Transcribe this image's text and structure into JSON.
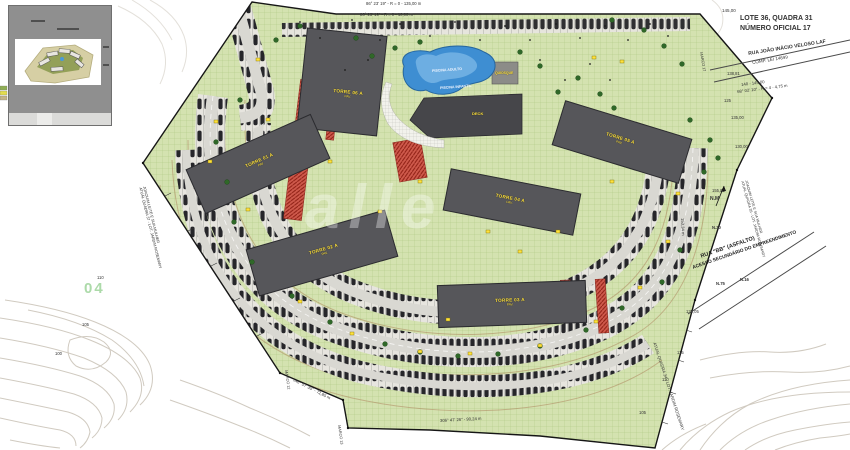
{
  "title_block": {
    "line1": "LOTE 36, QUADRA 31",
    "line2": "NÚMERO OFICIAL 17"
  },
  "streets": {
    "rua_joao_line1": "RUA JOÃO INÁCIO VELOSO LAF",
    "rua_joao_line2": "COMP. LEI 14699",
    "rua_bb_line1": "RUA \"BB\" (ASFALTO)",
    "rua_bb_line2": "ACESSO SECUNDÁRIO DO EMPREENDIMENTO"
  },
  "bearings": {
    "top_1": "86° 23' 19\" - R = 0 - 135,00 m",
    "top_2": "86° 23' 19\" - R = 0 - 10,00 m",
    "right_top": "68° 02' 10\" - R = 4 - 4,75 m",
    "right_len": "153,34 m",
    "bottom": "306° 47' 26\" - 90,24 m",
    "bottom_left": "146° 57' 35\" - 72,85 m"
  },
  "neighbors": {
    "left_line1": "JOAQUIM LEITE E SUA MULHER",
    "left_line2": "ATUAL QUADRA 37 - LOT. JARDIM ROSEMARY",
    "right_upper_line1": "JOAQUIM LEITE E SUA MULHER",
    "right_upper_line2": "ATUAL QUADRA 35 - LOT. JARDIM ROSEMARY",
    "bottom_right": "ATUAL QUADRA 34 - LOT. JARDIM ROSEMARY"
  },
  "towers": [
    {
      "label": "TORRE 01 A",
      "sub": "PAV."
    },
    {
      "label": "TORRE 02 A",
      "sub": "PAV."
    },
    {
      "label": "TORRE 03 A",
      "sub": "PAV."
    },
    {
      "label": "TORRE 04 A",
      "sub": "PAV."
    },
    {
      "label": "TORRE 05 A",
      "sub": "PAV."
    },
    {
      "label": "TORRE 06 A",
      "sub": "PAV."
    }
  ],
  "amenities": {
    "pool_adult": "PISCINA ADULTO",
    "pool_kids": "PISCINA INFANTIL",
    "deck": "DECK",
    "kiosk": "QUIOSQUE"
  },
  "survey_marks": {
    "marco_12": "MARCO 12",
    "marco_13": "MARCO 13",
    "marco_17": "MARCO 17",
    "n30": "N.30",
    "n75": "N.75",
    "n16": "N.16",
    "nm": "N.M"
  },
  "elevations": {
    "e145": "145,00",
    "e138": "138,81",
    "e140_145": "140 - 145,00",
    "e125": "125",
    "e135": "135,00",
    "e130": "130,00",
    "e155": "155,00",
    "e13505": "135,05",
    "e115": "115",
    "e110_r": "110",
    "e105_r": "105",
    "e110_l": "110",
    "e105_l": "105",
    "e100": "100"
  },
  "page_number": "04",
  "watermark": "alle",
  "colors": {
    "parcel_green": "#d4e2b0",
    "tower_gray": "#56565a",
    "label_yellow": "#ffe23c",
    "pool_blue": "#3e8ed2",
    "red_accent": "#cf5a4c",
    "road_gray": "#d9d8d2",
    "contour_brown": "#ab7f58"
  }
}
